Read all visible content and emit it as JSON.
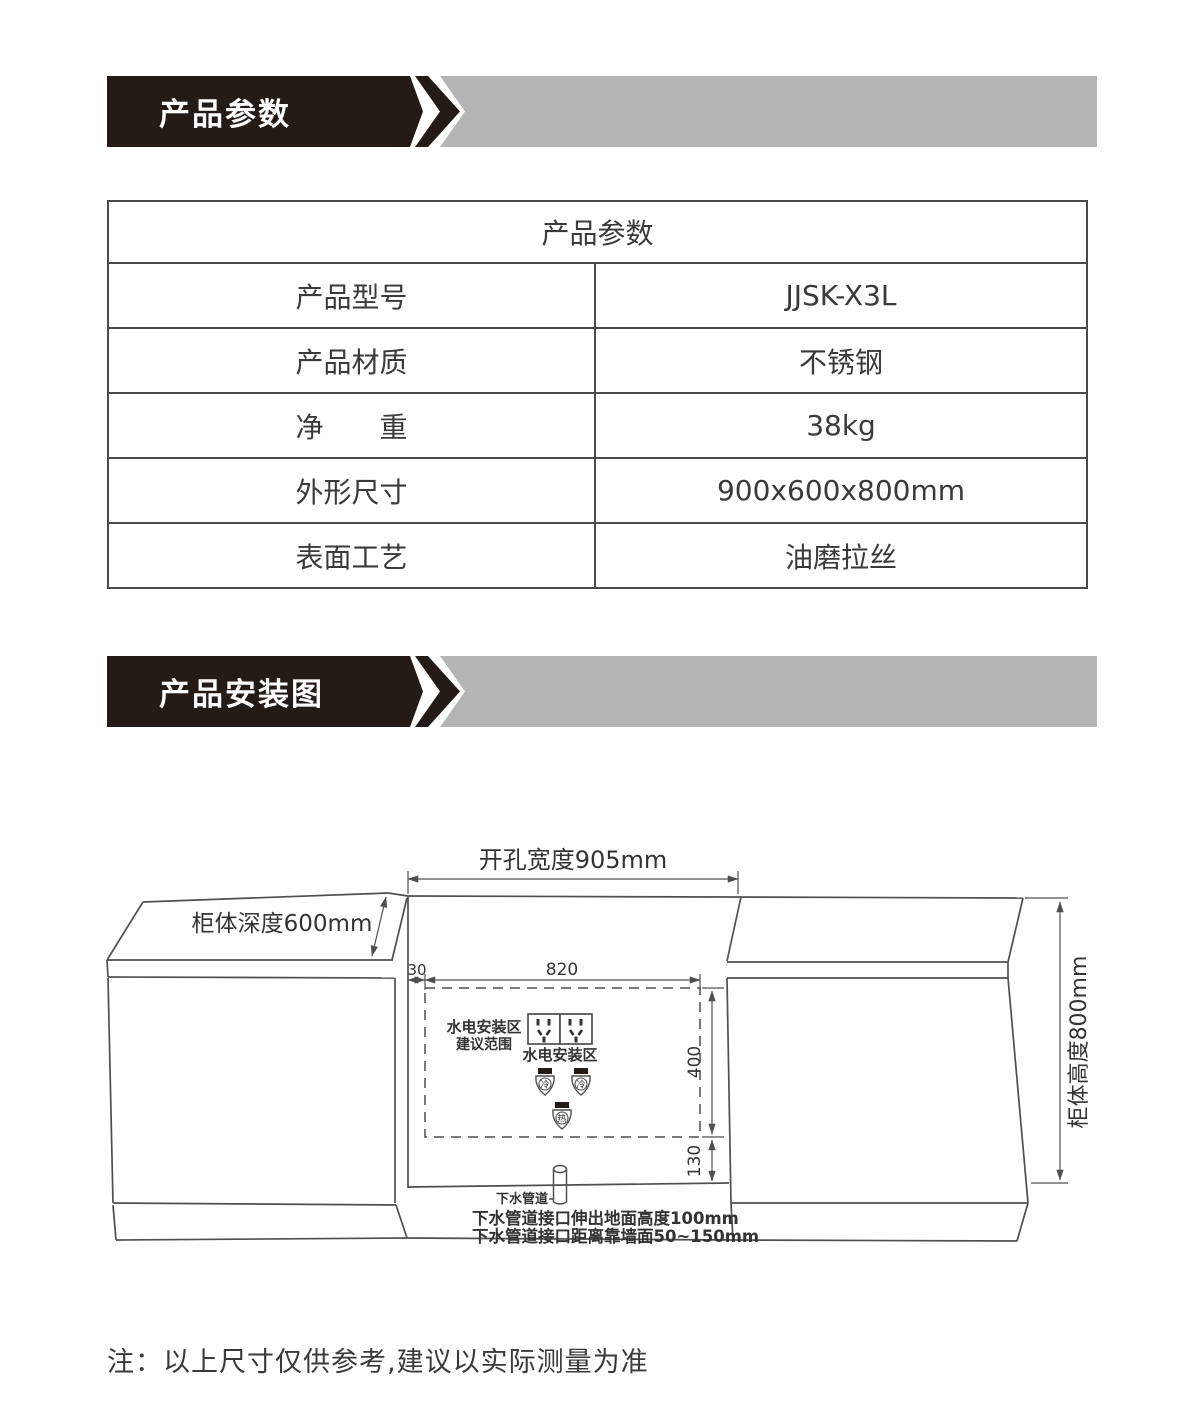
{
  "banners": {
    "params_label": "产品参数",
    "install_label": "产品安装图"
  },
  "colors": {
    "banner_black": "#241a16",
    "banner_gray": "#b5b5b6",
    "line_color": "#4f4f4f"
  },
  "spec_table": {
    "title": "产品参数",
    "rows": [
      {
        "label": "产品型号",
        "value": "JJSK-X3L"
      },
      {
        "label": "产品材质",
        "value": "不锈钢"
      },
      {
        "label": "净　　重",
        "value": "38kg"
      },
      {
        "label": "外形尺寸",
        "value": "900x600x800mm"
      },
      {
        "label": "表面工艺",
        "value": "油磨拉丝"
      }
    ]
  },
  "diagram": {
    "dims": {
      "opening_width": "开孔宽度905mm",
      "cabinet_depth": "柜体深度600mm",
      "cabinet_height": "柜体高度800mm",
      "offset_left": "30",
      "zone_width": "820",
      "zone_height": "400",
      "zone_bottom": "130"
    },
    "labels": {
      "zone_line1": "水电安装区",
      "zone_line2": "建议范围",
      "sockets_label": "水电安装区",
      "valve_cold": "冷",
      "valve_hot": "热",
      "drain_label": "下水管道",
      "drain_note1": "下水管道接口伸出地面高度100mm",
      "drain_note2": "下水管道接口距离靠墙面50~150mm"
    }
  },
  "footer_note": "注：以上尺寸仅供参考,建议以实际测量为准"
}
